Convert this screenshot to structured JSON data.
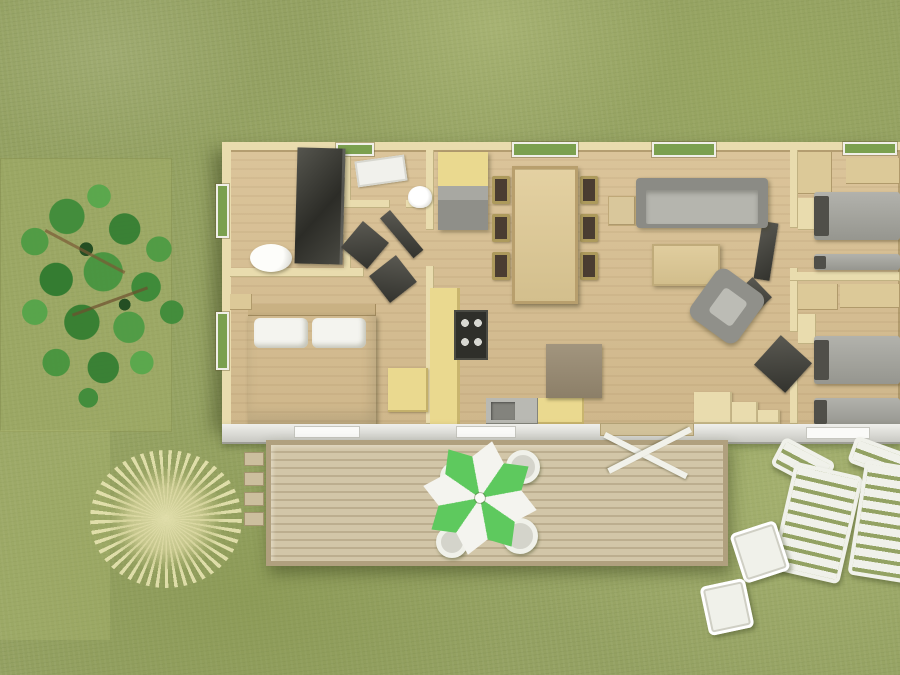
{
  "image_kind": "3d-aerial-floor-plan-render",
  "visible_text": [],
  "palette": {
    "grass": "#94a162",
    "grass_light": "#aab474",
    "grass_dark": "#7e8c4e",
    "floor": "#d8c096",
    "wall": "#e9dcae",
    "wood_light": "#dcc998",
    "window_green": "#7ba04f",
    "counter_yellow": "#ead98f",
    "furniture_gray": "#8f8f89",
    "shower_dark": "#33332e",
    "facade_white": "#e9e9e5",
    "deck": "#cfc3a5",
    "deck_gap": "#bcae8f",
    "parasol_green": "#5ec95e",
    "parasol_white": "#f4f4ef",
    "lounger_white": "#f0f1ea",
    "bed_white": "#e9e9e4",
    "tree_green": "#47953f",
    "bush_straw": "#d9d6a4"
  },
  "scene": {
    "environment": [
      "grass-lawn",
      "tree",
      "dry-bush"
    ],
    "building": {
      "rooms": [
        "bathroom",
        "wc",
        "entry-hall",
        "master-bedroom",
        "kitchen",
        "dining-area",
        "living-area",
        "hallway",
        "twin-bedroom-1",
        "twin-bedroom-2"
      ],
      "furniture": {
        "shower": 1,
        "washbasin": 1,
        "toilet": 1,
        "double-bed": 1,
        "pillows": 2,
        "wardrobe": 1,
        "fridge-cabinet": 1,
        "kitchen-counter": 2,
        "hob": 1,
        "kitchen-sink": 1,
        "dining-table": 1,
        "dining-chairs": 6,
        "sofa": 1,
        "side-table": 1,
        "coffee-table": 1,
        "armchair": 1,
        "desk": 1,
        "step-shelf": 1,
        "single-beds": 4,
        "open-doors": 6,
        "windows": 6
      }
    },
    "outdoor": {
      "wood-deck": 1,
      "deck-steps": 4,
      "parasol": 1,
      "deck-chairs": 4,
      "sun-loungers": 2,
      "lounge-side-tables": 2,
      "facade-windows": 3,
      "open-patio-door": 1
    }
  }
}
